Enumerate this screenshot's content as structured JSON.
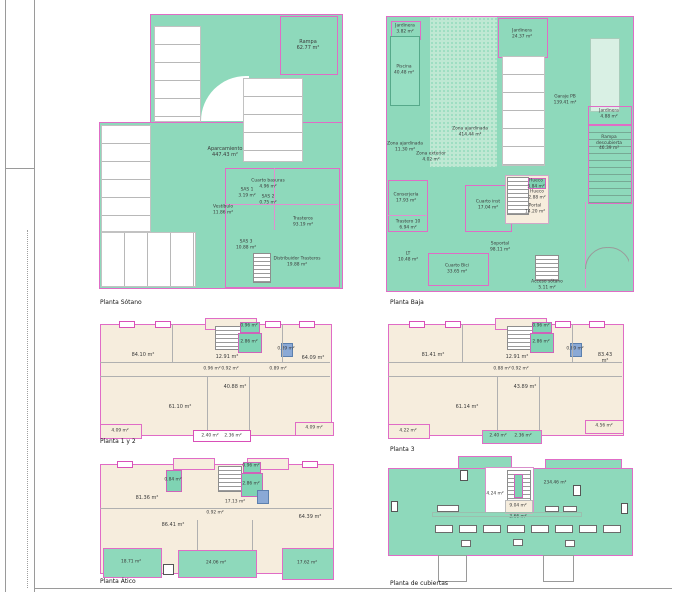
{
  "palette": {
    "green": "#8ed9bb",
    "light_green": "#d9f0e4",
    "speckled_green": "#bfe8d3",
    "beige": "#f6eddd",
    "outline_pink": "#e06cc6",
    "elevator_blue": "#8aa9d6"
  },
  "plans": [
    {
      "id": "sotano",
      "title": "Planta Sótano",
      "rooms": [
        {
          "label": "Rampa\n62.77 m²"
        },
        {
          "label": "Aparcamiento\n447.43 m²"
        },
        {
          "label": "Cuarto basuras\n4.96 m²"
        },
        {
          "label": "SAS 1\n3.19 m²"
        },
        {
          "label": "SAS 2\n0.75 m²"
        },
        {
          "label": "Vestíbulo\n11.86 m²"
        },
        {
          "label": "Trasteros\n93.19 m²"
        },
        {
          "label": "SAS 3\n10.88 m²"
        },
        {
          "label": "Distribuidor Trasteros\n19.88 m²"
        }
      ]
    },
    {
      "id": "baja",
      "title": "Planta Baja",
      "rooms": [
        {
          "label": "Jardinera\n3.82 m²"
        },
        {
          "label": "Piscina\n40.48 m²"
        },
        {
          "label": "Jardinera\n24.37 m²"
        },
        {
          "label": "Zona ajardinada\n414.44 m²"
        },
        {
          "label": "Zona ajardinada\n11.30 m²"
        },
        {
          "label": "Zona exterior\n4.02 m²"
        },
        {
          "label": "Garaje PB\n139.41 m²"
        },
        {
          "label": "Jardinera\n4.88 m²"
        },
        {
          "label": "Rampa descubierta\n46.39 m²"
        },
        {
          "label": "Conserjería\n17.93 m²"
        },
        {
          "label": "Trastero 10\n6.94 m²"
        },
        {
          "label": "LT\n10.48 m²"
        },
        {
          "label": "Cuarto inst\n17.04 m²"
        },
        {
          "label": "Hueco\n3.84 m²"
        },
        {
          "label": "Hueco\n2.88 m²"
        },
        {
          "label": "Portal\n14.20 m²"
        },
        {
          "label": "Soportal\n98.11 m²"
        },
        {
          "label": "Cuarto Bici\n33.65 m²"
        },
        {
          "label": "Acceso sótano\n5.11 m²"
        }
      ]
    },
    {
      "id": "planta-1-y-2",
      "title": "Planta 1 y 2",
      "rooms": [
        {
          "label": "84.10 m²"
        },
        {
          "label": "12.91 m²"
        },
        {
          "label": "64.09 m²"
        },
        {
          "label": "0.96 m²"
        },
        {
          "label": "2.86 m²"
        },
        {
          "label": "0.89 m²"
        },
        {
          "label": "0.96 m²"
        },
        {
          "label": "0.92 m²"
        },
        {
          "label": "0.89 m²"
        },
        {
          "label": "40.88 m²"
        },
        {
          "label": "61.10 m²"
        },
        {
          "label": "4.09 m²"
        },
        {
          "label": "2.40 m²"
        },
        {
          "label": "2.36 m²"
        },
        {
          "label": "4.09 m²"
        }
      ]
    },
    {
      "id": "planta-3",
      "title": "Planta 3",
      "rooms": [
        {
          "label": "81.41 m²"
        },
        {
          "label": "12.91 m²"
        },
        {
          "label": "83.43 m²"
        },
        {
          "label": "0.96 m²"
        },
        {
          "label": "2.86 m²"
        },
        {
          "label": "0.89 m²"
        },
        {
          "label": "0.88 m²"
        },
        {
          "label": "0.92 m²"
        },
        {
          "label": "43.89 m²"
        },
        {
          "label": "61.14 m²"
        },
        {
          "label": "4.22 m²"
        },
        {
          "label": "2.40 m²"
        },
        {
          "label": "2.36 m²"
        },
        {
          "label": "4.56 m²"
        }
      ]
    },
    {
      "id": "atico",
      "title": "Planta Ático",
      "rooms": [
        {
          "label": "81.36 m²"
        },
        {
          "label": "0.84 m²"
        },
        {
          "label": "0.96 m²"
        },
        {
          "label": "2.86 m²"
        },
        {
          "label": "17.13 m²"
        },
        {
          "label": "0.92 m²"
        },
        {
          "label": "86.41 m²"
        },
        {
          "label": "64.39 m²"
        },
        {
          "label": "18.71 m²"
        },
        {
          "label": "24.06 m²"
        },
        {
          "label": "17.62 m²"
        }
      ]
    },
    {
      "id": "cubiertas",
      "title": "Planta de cubiertas",
      "rooms": [
        {
          "label": "234.46 m²"
        },
        {
          "label": "4.24 m²"
        },
        {
          "label": "9.04 m²"
        },
        {
          "label": "3.66 m²"
        }
      ]
    }
  ]
}
